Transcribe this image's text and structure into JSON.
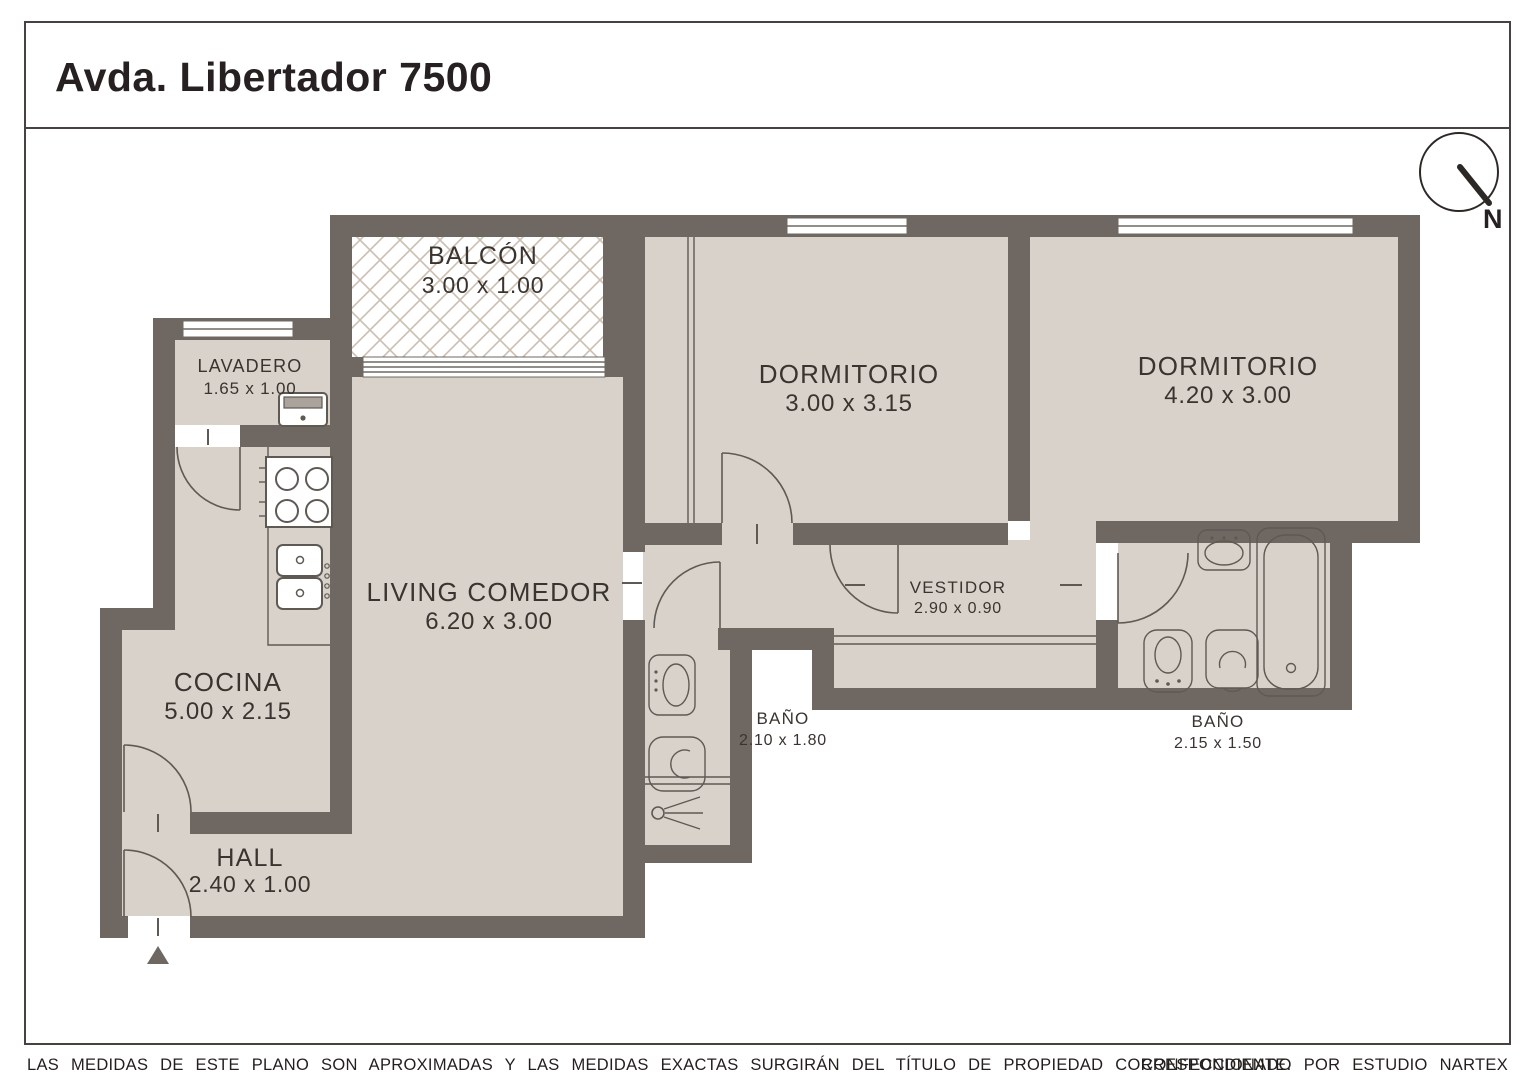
{
  "title": "Avda. Libertador 7500",
  "compass": {
    "north_label": "N"
  },
  "rooms": {
    "balcon": {
      "name": "BALCÓN",
      "dims": "3.00 x 1.00"
    },
    "lavadero": {
      "name": "LAVADERO",
      "dims": "1.65 x 1.00"
    },
    "dormitorio1": {
      "name": "DORMITORIO",
      "dims": "3.00 x 3.15"
    },
    "dormitorio2": {
      "name": "DORMITORIO",
      "dims": "4.20 x 3.00"
    },
    "living": {
      "name": "LIVING COMEDOR",
      "dims": "6.20 x 3.00"
    },
    "cocina": {
      "name": "COCINA",
      "dims": "5.00 x 2.15"
    },
    "vestidor": {
      "name": "VESTIDOR",
      "dims": "2.90 x 0.90"
    },
    "bano1": {
      "name": "BAÑO",
      "dims": "2.10 x 1.80"
    },
    "bano2": {
      "name": "BAÑO",
      "dims": "2.15 x 1.50"
    },
    "hall": {
      "name": "HALL",
      "dims": "2.40 x 1.00"
    }
  },
  "footer": {
    "disclaimer": "LAS MEDIDAS  DE ESTE PLANO SON APROXIMADAS Y LAS MEDIDAS EXACTAS SURGIRÁN DEL TÍTULO DE PROPIEDAD CORRESPONDIENTE.",
    "credit": "CONFECCIONADO POR ESTUDIO NARTEX"
  },
  "colors": {
    "wall": "#6f6862",
    "floor": "#d9d2cb",
    "hatch": "#cbbfb2",
    "line": "#5f5954",
    "text": "#3a3430",
    "border": "#474240",
    "paper": "#ffffff"
  }
}
